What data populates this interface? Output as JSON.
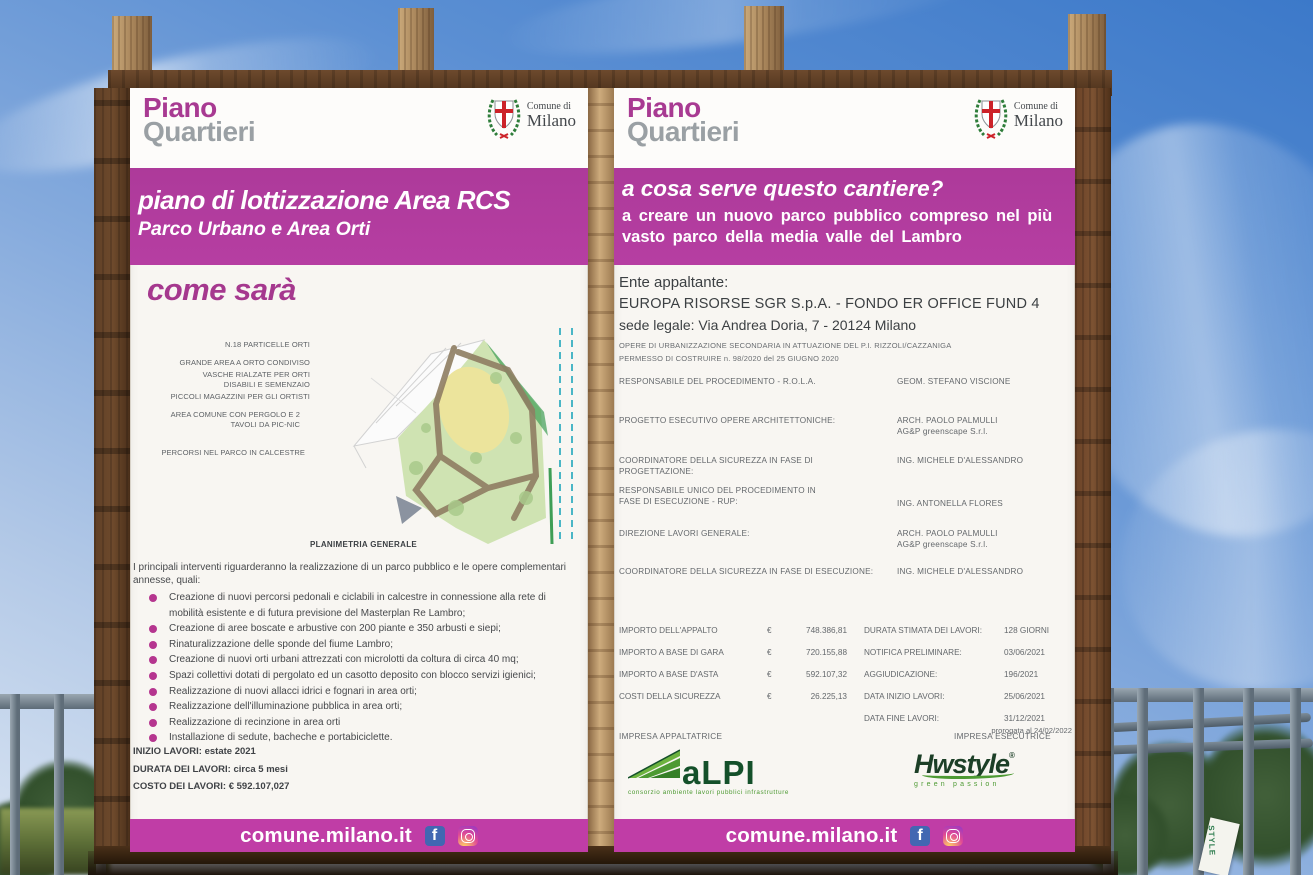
{
  "colors": {
    "accent_magenta": "#b23c9e",
    "footer_magenta": "#c03da6",
    "brand_gray": "#9aa0a4",
    "alpi_green": "#14502a",
    "hwstyle_green": "#1c3f27",
    "sky_blue": "#3c79c9"
  },
  "scene": {
    "banner_text": "STYLE"
  },
  "brand": {
    "line1": "Piano",
    "line2": "Quartieri"
  },
  "municipality": {
    "line1": "Comune di",
    "line2": "Milano"
  },
  "left_board": {
    "title": "piano di lottizzazione Area RCS",
    "subtitle": "Parco Urbano e Area Orti",
    "section_heading": "come sarà",
    "map": {
      "caption": "PLANIMETRIA GENERALE",
      "annotations": [
        "N.18 PARTICELLE ORTI",
        "GRANDE AREA A ORTO CONDIVISO",
        "VASCHE RIALZATE PER ORTI DISABILI E SEMENZAIO",
        "PICCOLI MAGAZZINI PER GLI ORTISTI",
        "AREA COMUNE CON PERGOLO E 2 TAVOLI DA PIC-NIC",
        "PERCORSI NEL PARCO IN CALCESTRE"
      ]
    },
    "intro": "I principali interventi riguarderanno la realizzazione di un parco pubblico e le opere complementari annesse, quali:",
    "bullets": [
      "Creazione di nuovi percorsi pedonali e ciclabili in calcestre in connessione alla rete di mobilità esistente e di futura previsione del Masterplan Re Lambro;",
      "Creazione di aree boscate e arbustive con 200 piante e 350 arbusti e siepi;",
      "Rinaturalizzazione delle sponde del fiume Lambro;",
      "Creazione di nuovi orti urbani attrezzati con microlotti da coltura di circa 40 mq;",
      "Spazi collettivi dotati di pergolato ed un casotto deposito con blocco servizi igienici;",
      "Realizzazione di nuovi allacci idrici e fognari in area orti;",
      "Realizzazione dell'illuminazione pubblica in area orti;",
      "Realizzazione di recinzione in area orti",
      "Installazione di sedute, bacheche e portabiciclette."
    ],
    "facts": [
      "INIZIO LAVORI: estate 2021",
      "DURATA DEI LAVORI: circa 5 mesi",
      "COSTO DEI LAVORI: € 592.107,027"
    ],
    "footer_url": "comune.milano.it"
  },
  "right_board": {
    "question": "a cosa serve questo cantiere?",
    "answer_line1": "a creare un nuovo parco pubblico compreso nel più",
    "answer_line2": "vasto parco della media valle del Lambro",
    "client": {
      "label": "Ente appaltante:",
      "name": "EUROPA RISORSE SGR S.p.A. - FONDO ER OFFICE FUND 4",
      "address": "sede legale: Via Andrea Doria, 7 - 20124 Milano",
      "note1": "OPERE DI URBANIZZAZIONE SECONDARIA IN ATTUAZIONE DEL P.I. RIZZOLI/CAZZANIGA",
      "note2": "PERMESSO DI COSTRUIRE n. 98/2020 del 25 GIUGNO 2020"
    },
    "roles": [
      {
        "label": "RESPONSABILE DEL PROCEDIMENTO - R.O.L.A.",
        "value": "GEOM. STEFANO VISCIONE",
        "value2": ""
      },
      {
        "label": "PROGETTO ESECUTIVO OPERE ARCHITETTONICHE:",
        "value": "ARCH. PAOLO PALMULLI",
        "value2": "AG&P greenscape S.r.l."
      },
      {
        "label": "COORDINATORE DELLA SICUREZZA IN FASE DI PROGETTAZIONE:",
        "value": "ING. MICHELE D'ALESSANDRO",
        "value2": ""
      },
      {
        "label": "RESPONSABILE UNICO DEL PROCEDIMENTO IN FASE DI ESECUZIONE - RUP:",
        "value": "ING. ANTONELLA FLORES",
        "value2": ""
      },
      {
        "label": "DIREZIONE LAVORI GENERALE:",
        "value": "ARCH. PAOLO PALMULLI",
        "value2": "AG&P greenscape S.r.l."
      },
      {
        "label": "COORDINATORE DELLA SICUREZZA IN FASE DI ESECUZIONE:",
        "value": "ING. MICHELE D'ALESSANDRO",
        "value2": ""
      }
    ],
    "amounts": [
      {
        "label": "IMPORTO DELL'APPALTO",
        "currency": "€",
        "value": "748.386,81"
      },
      {
        "label": "IMPORTO A BASE DI GARA",
        "currency": "€",
        "value": "720.155,88"
      },
      {
        "label": "IMPORTO A BASE D'ASTA",
        "currency": "€",
        "value": "592.107,32"
      },
      {
        "label": "COSTI DELLA SICUREZZA",
        "currency": "€",
        "value": "26.225,13"
      }
    ],
    "schedule": [
      {
        "label": "DURATA STIMATA DEI LAVORI:",
        "value": "128 GIORNI",
        "note": ""
      },
      {
        "label": "NOTIFICA PRELIMINARE:",
        "value": "03/06/2021",
        "note": ""
      },
      {
        "label": "AGGIUDICAZIONE:",
        "value": "196/2021",
        "note": ""
      },
      {
        "label": "DATA INIZIO LAVORI:",
        "value": "25/06/2021",
        "note": ""
      },
      {
        "label": "DATA FINE LAVORI:",
        "value": "31/12/2021",
        "note": "prorogata al 24/02/2022"
      }
    ],
    "contractor": {
      "label": "IMPRESA APPALTATRICE",
      "logo_text": "aLPI",
      "tagline": "consorzio ambiente lavori pubblici infrastrutture"
    },
    "executor": {
      "label": "IMPRESA ESECUTRICE",
      "logo_text": "Hwstyle",
      "trademark": "®",
      "tagline": "green passion"
    },
    "footer_url": "comune.milano.it"
  }
}
